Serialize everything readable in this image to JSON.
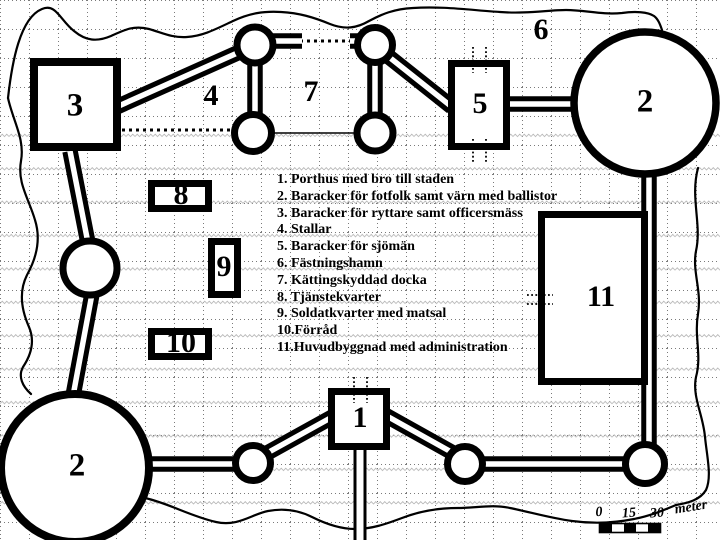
{
  "map_labels": {
    "gatehouse": "1",
    "barracks_ne": "2",
    "barracks_sw": "2",
    "cavalry_barracks": "3",
    "stables": "4",
    "sailor_barracks": "5",
    "harbor": "6",
    "dock": "7",
    "service_quarters": "8",
    "soldier_quarters": "9",
    "storage": "10",
    "main_building": "11"
  },
  "legend": {
    "items": [
      "1. Porthus med bro till staden",
      "2. Baracker för fotfolk samt värn med ballistor",
      "3. Baracker för ryttare samt officersmäss",
      "4. Stallar",
      "5. Baracker för sjömän",
      "6. Fästningshamn",
      "7. Kättingskyddad docka",
      "8. Tjänstekvarter",
      "9. Soldatkvarter med matsal",
      "10.Förråd",
      "11.Huvudbyggnad med administration"
    ]
  },
  "scale_bar": {
    "ticks": [
      "0",
      "15",
      "30"
    ],
    "unit": "meter"
  },
  "colors": {
    "ink": "#000000",
    "paper": "#ffffff",
    "grid": "#7a7a7a"
  }
}
